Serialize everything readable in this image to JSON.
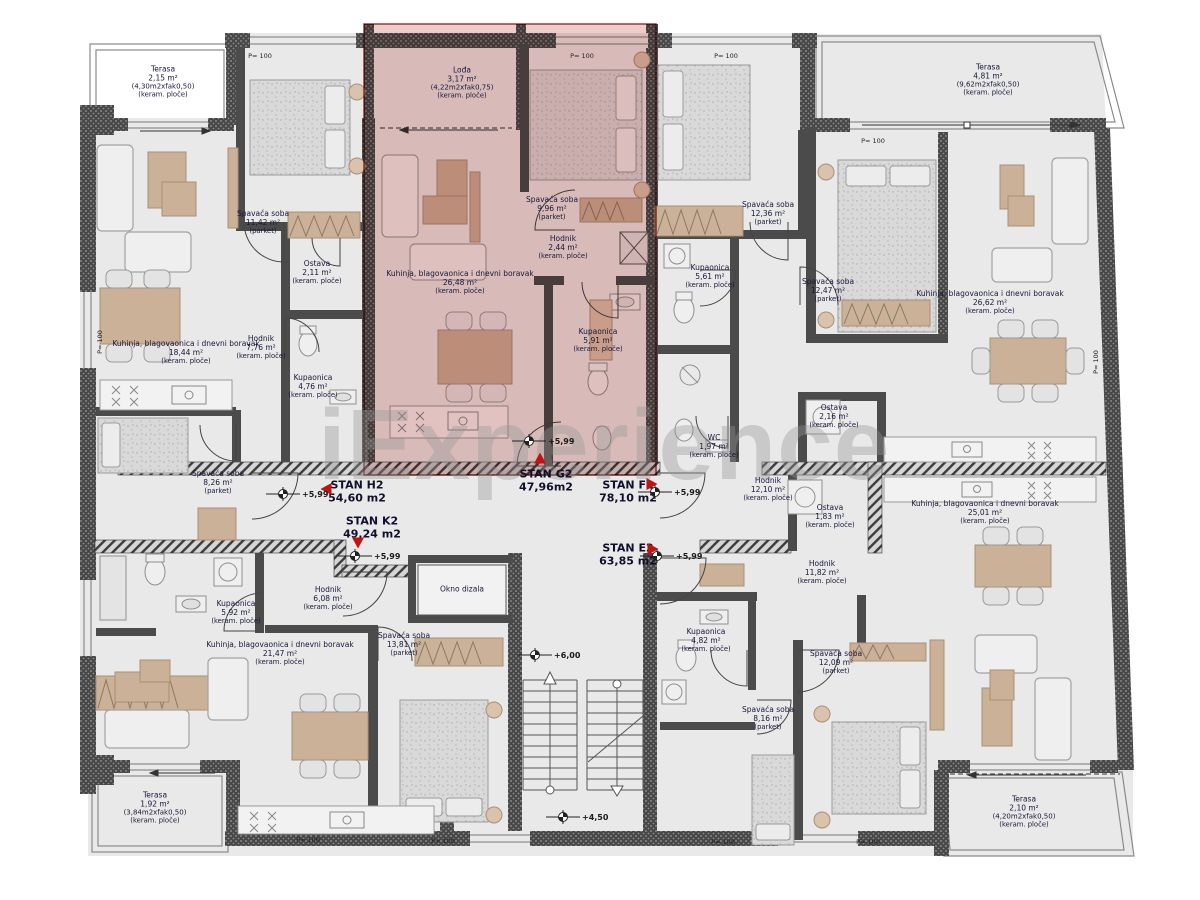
{
  "watermark": "iExperience",
  "apartments": [
    {
      "name": "STAN H2",
      "area": "54,60 m2",
      "x": 357,
      "y": 492,
      "marker": "left",
      "mx": 326,
      "my": 489
    },
    {
      "name": "STAN K2",
      "area": "49,24 m2",
      "x": 372,
      "y": 528,
      "marker": "down",
      "mx": 358,
      "my": 543
    },
    {
      "name": "STAN G2",
      "area": "47,96m2",
      "x": 546,
      "y": 481,
      "marker": "up",
      "mx": 540,
      "my": 458
    },
    {
      "name": "STAN F2",
      "area": "78,10 m2",
      "x": 628,
      "y": 492,
      "marker": "right",
      "mx": 652,
      "my": 484
    },
    {
      "name": "STAN E2",
      "area": "63,85 m2",
      "x": 628,
      "y": 555,
      "marker": "right",
      "mx": 653,
      "my": 549
    }
  ],
  "rooms": [
    {
      "name": "Terasa",
      "area": "2,15 m²",
      "dims": "(4,30m2xfak0,50)",
      "finish": "(keram. ploče)",
      "x": 163,
      "y": 82
    },
    {
      "name": "Spavaća soba",
      "area": "11,42 m²",
      "finish": "(parket)",
      "x": 263,
      "y": 222
    },
    {
      "name": "Ostava",
      "area": "2,11 m²",
      "finish": "(keram. ploče)",
      "x": 317,
      "y": 272
    },
    {
      "name": "Kuhinja, blagovaonica i dnevni boravak",
      "area": "18,44 m²",
      "finish": "(keram. ploče)",
      "x": 186,
      "y": 352
    },
    {
      "name": "Hodnik",
      "area": "7,76 m²",
      "finish": "(keram. ploče)",
      "x": 261,
      "y": 347
    },
    {
      "name": "Kupaonica",
      "area": "4,76 m²",
      "finish": "(keram. ploče)",
      "x": 313,
      "y": 386
    },
    {
      "name": "Spavaća soba",
      "area": "8,26 m²",
      "finish": "(parket)",
      "x": 218,
      "y": 482
    },
    {
      "name": "Lođa",
      "area": "3,17 m²",
      "dims": "(4,22m2xfak0,75)",
      "finish": "(keram. ploče)",
      "x": 462,
      "y": 83
    },
    {
      "name": "Spavaća soba",
      "area": "9,96 m²",
      "finish": "(parket)",
      "x": 552,
      "y": 208
    },
    {
      "name": "Hodnik",
      "area": "2,44 m²",
      "finish": "(keram. ploče)",
      "x": 563,
      "y": 247
    },
    {
      "name": "Kuhinja, blagovaonica i dnevni boravak",
      "area": "26,48 m²",
      "finish": "(keram. ploče)",
      "x": 460,
      "y": 282
    },
    {
      "name": "Kupaonica",
      "area": "5,91 m²",
      "finish": "(keram. ploče)",
      "x": 598,
      "y": 340
    },
    {
      "name": "Spavaća soba",
      "area": "12,36 m²",
      "finish": "(parket)",
      "x": 768,
      "y": 213
    },
    {
      "name": "Kupaonica",
      "area": "5,61 m²",
      "finish": "(keram. ploče)",
      "x": 710,
      "y": 276
    },
    {
      "name": "Spavaća soba",
      "area": "12,47 m²",
      "finish": "(parket)",
      "x": 828,
      "y": 290
    },
    {
      "name": "WC",
      "area": "1,97 m²",
      "finish": "(keram. ploče)",
      "x": 714,
      "y": 446
    },
    {
      "name": "Hodnik",
      "area": "12,10 m²",
      "finish": "(keram. ploče)",
      "x": 768,
      "y": 489
    },
    {
      "name": "Kuhinja, blagovaonica i dnevni boravak",
      "area": "26,62 m²",
      "finish": "(keram. ploče)",
      "x": 990,
      "y": 302
    },
    {
      "name": "Ostava",
      "area": "2,16 m²",
      "finish": "(keram. ploče)",
      "x": 834,
      "y": 416
    },
    {
      "name": "Terasa",
      "area": "4,81 m²",
      "dims": "(9,62m2xfak0,50)",
      "finish": "(keram. ploče)",
      "x": 988,
      "y": 80
    },
    {
      "name": "Ostava",
      "area": "1,83 m²",
      "finish": "(keram. ploče)",
      "x": 830,
      "y": 516
    },
    {
      "name": "Kuhinja, blagovaonica i dnevni boravak",
      "area": "25,01 m²",
      "finish": "(keram. ploče)",
      "x": 985,
      "y": 512
    },
    {
      "name": "Hodnik",
      "area": "11,82 m²",
      "finish": "(keram. ploče)",
      "x": 822,
      "y": 572
    },
    {
      "name": "Kupaonica",
      "area": "4,82 m²",
      "finish": "(keram. ploče)",
      "x": 706,
      "y": 640
    },
    {
      "name": "Spavaća soba",
      "area": "8,16 m²",
      "finish": "(parket)",
      "x": 768,
      "y": 718
    },
    {
      "name": "Spavaća soba",
      "area": "12,09 m²",
      "finish": "(parket)",
      "x": 836,
      "y": 662
    },
    {
      "name": "Terasa",
      "area": "2,10 m²",
      "dims": "(4,20m2xfak0,50)",
      "finish": "(keram. ploče)",
      "x": 1024,
      "y": 812
    },
    {
      "name": "Kupaonica",
      "area": "5,92 m²",
      "finish": "(keram. ploče)",
      "x": 236,
      "y": 612
    },
    {
      "name": "Hodnik",
      "area": "6,08 m²",
      "finish": "(keram. ploče)",
      "x": 328,
      "y": 598
    },
    {
      "name": "Kuhinja, blagovaonica i dnevni boravak",
      "area": "21,47 m²",
      "finish": "(keram. ploče)",
      "x": 280,
      "y": 653
    },
    {
      "name": "Spavaća soba",
      "area": "13,81 m²",
      "finish": "(parket)",
      "x": 404,
      "y": 644
    },
    {
      "name": "Terasa",
      "area": "1,92 m²",
      "dims": "(3,84m2xfak0,50)",
      "finish": "(keram. ploče)",
      "x": 155,
      "y": 808
    }
  ],
  "elevator": {
    "label": "Okno dizala",
    "x": 462,
    "y": 589
  },
  "elevations": [
    {
      "label": "+5,99",
      "x": 288,
      "y": 494
    },
    {
      "label": "+5,99",
      "x": 534,
      "y": 441
    },
    {
      "label": "+5,99",
      "x": 360,
      "y": 556
    },
    {
      "label": "+5,99",
      "x": 660,
      "y": 492
    },
    {
      "label": "+5,99",
      "x": 662,
      "y": 556
    },
    {
      "label": "+6,00",
      "x": 540,
      "y": 655
    },
    {
      "label": "+4,50",
      "x": 568,
      "y": 817
    }
  ],
  "wall_labels": [
    {
      "label": "P= 100",
      "x": 260,
      "y": 56
    },
    {
      "label": "P= 100",
      "x": 582,
      "y": 56
    },
    {
      "label": "P= 100",
      "x": 726,
      "y": 56
    },
    {
      "label": "P= 100",
      "x": 873,
      "y": 141
    },
    {
      "label": "P= 100",
      "x": 308,
      "y": 840
    },
    {
      "label": "P= 100",
      "x": 443,
      "y": 841
    },
    {
      "label": "P= 100",
      "x": 723,
      "y": 842
    },
    {
      "label": "P= 100",
      "x": 868,
      "y": 842
    },
    {
      "label": "P= 100",
      "x": 100,
      "y": 342,
      "rot": true
    },
    {
      "label": "P= 100",
      "x": 1096,
      "y": 362,
      "rot": true
    }
  ],
  "colors": {
    "highlight": "#c96b66",
    "marker": "#c01414",
    "wall": "#4a4a4a",
    "tan": "#cbb198",
    "floor": "#e9e9e9"
  }
}
